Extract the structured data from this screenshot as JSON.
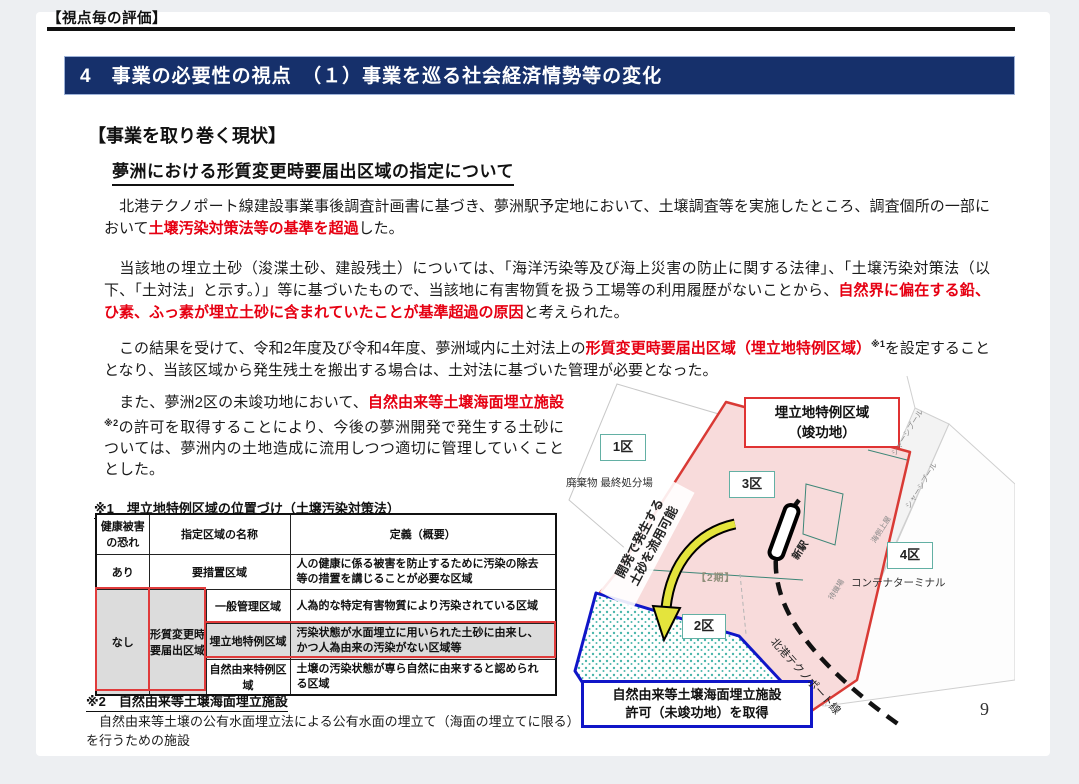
{
  "page": {
    "kicker": "【視点毎の評価】",
    "banner_title": "4　事業の必要性の視点　（１）事業を巡る社会経済情勢等の変化",
    "section_heading": "【事業を取り巻く現状】",
    "subsection_title": "夢洲における形質変更時要届出区域の指定について",
    "page_number": "9"
  },
  "colors": {
    "banner_bg": "#16306b",
    "accent_red": "#e60012",
    "map_region_red": "#d93a35",
    "map_region_pink": "#f8dbdb",
    "map_region_blue": "#1016c8",
    "zone_box_teal": "#63b0a4",
    "table_highlight_gray": "#dcdcdc"
  },
  "paragraphs": {
    "p1_pre": "　北港テクノポート線建設事業事後調査計画書に基づき、夢洲駅予定地において、土壌調査等を実施したところ、調査個所の一部において",
    "p1_red": "土壌汚染対策法等の基準を超過",
    "p1_post": "した。",
    "p2_pre": "　当該地の埋立土砂（浚渫土砂、建設残土）については、「海洋汚染等及び海上災害の防止に関する法律」、「土壌汚染対策法（以下、「土対法」と示す。）」等に基づいたもので、当該地に有害物質を扱う工場等の利用履歴がないことから、",
    "p2_red": "自然界に偏在する鉛、ひ素、ふっ素が埋立土砂に含まれていたことが基準超過の原因",
    "p2_post": "と考えられた。",
    "p3_pre": "　この結果を受けて、令和2年度及び令和4年度、夢洲域内に土対法上の",
    "p3_red": "形質変更時要届出区域（埋立地特例区域）",
    "p3_sup": "※1",
    "p3_post": "を設定することとなり、当該区域から発生残土を搬出する場合は、土対法に基づいた管理が必要となった。",
    "p4_pre": "　また、夢洲2区の未竣功地において、",
    "p4_red": "自然由来等土壌海面埋立施設",
    "p4_sup": "※2",
    "p4_post": "の許可を取得することにより、今後の夢洲開発で発生する土砂については、夢洲内の土地造成に流用しつつ適切に管理していくこととした。"
  },
  "note1": {
    "caption": "※1　埋立地特例区域の位置づけ（土壌汚染対策法）",
    "table": {
      "col_risk": "健康被害の恐れ",
      "col_name": "指定区域の名称",
      "col_def": "定義（概要）",
      "row_ari_risk": "あり",
      "row_ari_name": "要措置区域",
      "row_ari_def": "人の健康に係る被害を防止するために汚染の除去等の措置を講じることが必要な区域",
      "row_nashi_risk": "なし",
      "row_nashi_group": "形質変更時要届出区域",
      "sub1_name": "一般管理区域",
      "sub1_def": "人為的な特定有害物質により汚染されている区域",
      "sub2_name": "埋立地特例区域",
      "sub2_def": "汚染状態が水面埋立に用いられた土砂に由来し、かつ人為由来の汚染がない区域等",
      "sub3_name": "自然由来特例区域",
      "sub3_def": "土壌の汚染状態が専ら自然に由来すると認められる区域"
    }
  },
  "note2": {
    "caption": "※2　自然由来等土壌海面埋立施設",
    "body": "　自然由来等土壌の公有水面埋立法による公有水面の埋立て（海面の埋立てに限る）を行うための施設"
  },
  "map": {
    "district1": "1区",
    "district2": "2区",
    "district3": "3区",
    "district4": "4区",
    "waste_site": "廃棄物 最終処分場",
    "container_terminal": "コンテナターミナル",
    "phase2": "【2期】",
    "reclaimed_label_line1": "埋立地特例区域",
    "reclaimed_label_line2": "（竣功地）",
    "natural_label_line1": "自然由来等土壌海面埋立施設",
    "natural_label_line2": "許可（未竣功地）を取得",
    "reuse_label_line1": "開発で発生する",
    "reuse_label_line2": "土砂を流用可能",
    "new_station": "新駅",
    "rail_line": "北港テクノポート線",
    "road_labels": [
      "シャーシプール",
      "シャーシプール",
      "海側上屋",
      "待機場"
    ]
  }
}
